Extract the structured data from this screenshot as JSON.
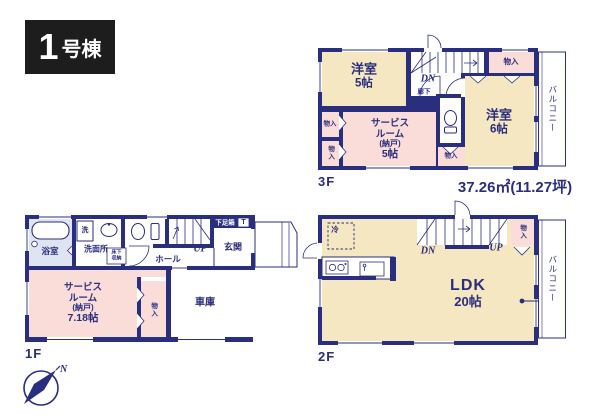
{
  "unit": {
    "number": "1",
    "suffix": "号棟"
  },
  "area_text": "37.26㎡(11.27坪)",
  "compass": {
    "north": "N"
  },
  "colors": {
    "wall_navy": "#2a2e7e",
    "room_cream": "#f5e7c1",
    "room_pink": "#fadcd9",
    "bath_blue": "#dfe4f2",
    "title_black": "#1d1d1d",
    "background": "#ffffff"
  },
  "f3": {
    "label": "3F",
    "yoshitsu5_name": "洋室",
    "yoshitsu5_size": "5帖",
    "yoshitsu6_name": "洋室",
    "yoshitsu6_size": "6帖",
    "service_l1": "サービス",
    "service_l2": "ルーム",
    "service_l3": "(納戸)",
    "service_l4": "5帖",
    "closet_top": "物入",
    "closet_left_a": "物入",
    "closet_left_b": "物入",
    "closet_bottom": "物入",
    "corridor": "廊下",
    "dn": "DN",
    "balcony": "バルコニー"
  },
  "f1": {
    "label": "1F",
    "bath": "浴室",
    "washer": "洗",
    "washroom": "洗面所",
    "storage_l1": "床下",
    "storage_l2": "収納",
    "hall": "ホール",
    "up": "UP",
    "shoebox": "下足箱",
    "toilet_mark": "T",
    "entrance": "玄関",
    "service_l1": "サービス",
    "service_l2": "ルーム",
    "service_l3": "(納戸)",
    "service_l4": "7.18帖",
    "closet": "物入",
    "garage": "車庫"
  },
  "f2": {
    "label": "2F",
    "fridge": "冷",
    "dn": "DN",
    "up": "UP",
    "closet": "物入",
    "ldk_name": "LDK",
    "ldk_size": "20帖",
    "balcony": "バルコニー"
  }
}
